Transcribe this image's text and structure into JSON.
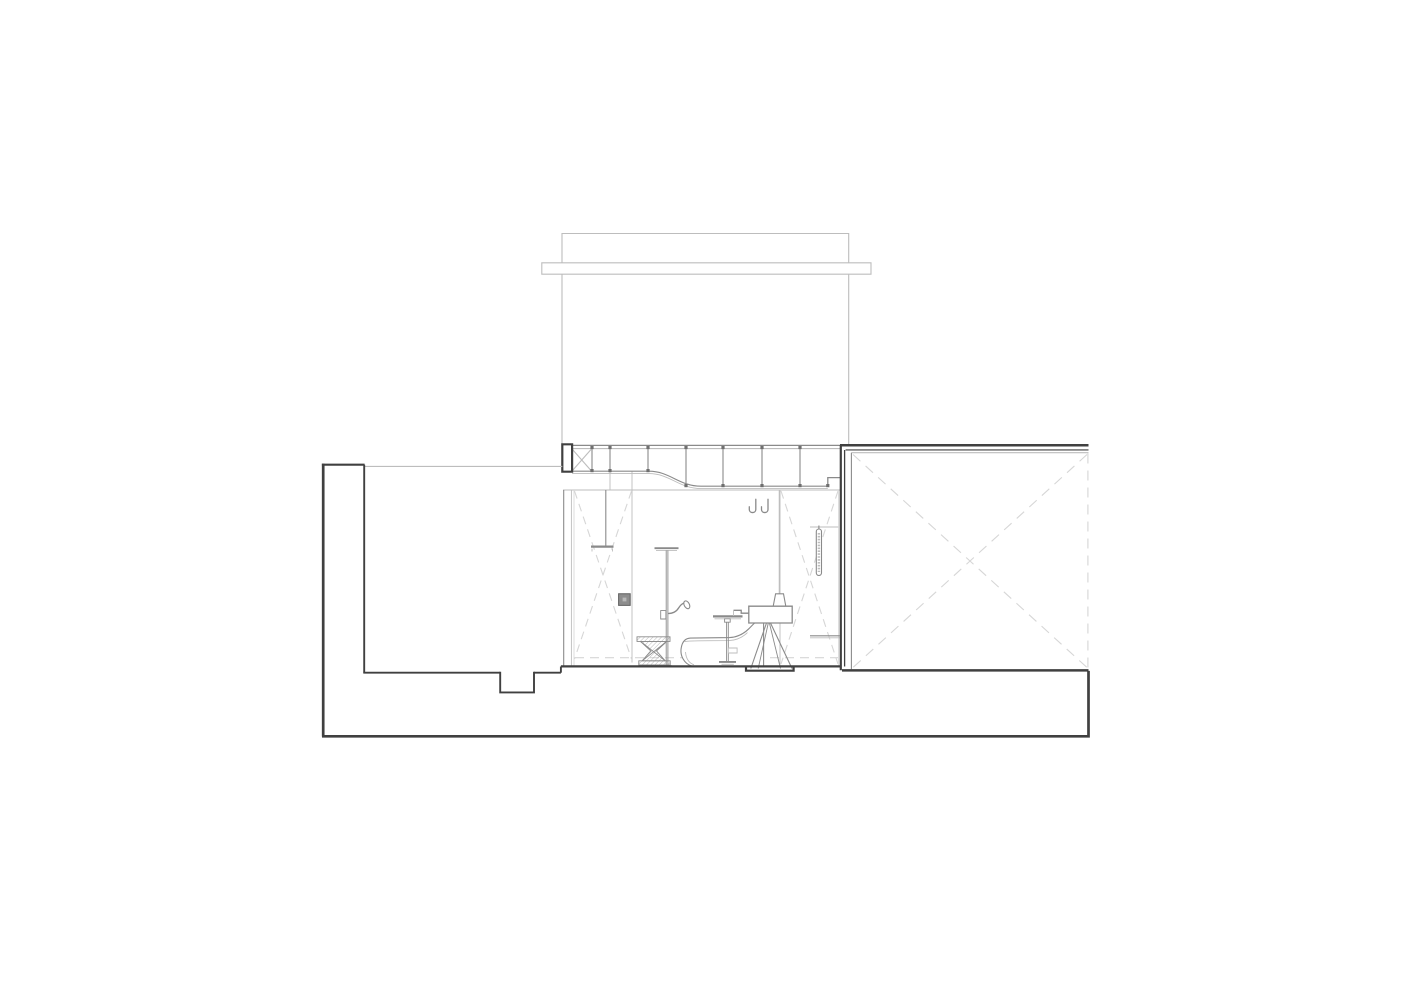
{
  "drawing": {
    "kind": "architectural-section-line-drawing",
    "palette": {
      "paper": "#ffffff",
      "line_dark": "#404040",
      "line_medium": "#8a8a8a",
      "line_light": "#bdbdbd",
      "line_faint": "#d6d6d6",
      "node_fill": "#6f6f6f",
      "panel_fill": "#8d8d8d",
      "panel_border": "#5f5f5f",
      "panel_inner": "#b8b8b8",
      "hatch_stroke": "#9a9a9a"
    },
    "elements": {
      "upper_volume": "tall upper volume outline",
      "roof_band": "horizontal band across upper volume",
      "roof_truss": "ceiling truss with posts, nodes and s-curved soffit",
      "truss_column": "section-cut column at truss left end",
      "left_wing": "left wing walls with underside notch",
      "right_box": "right volume with dashed cross bracing",
      "base_plinth": "continuous base plinth",
      "room": "central room shell with dashed wall braces",
      "ceiling_shower": "ceiling mounted shower head on drop rod",
      "shower_column": "freestanding shower column with hand spout",
      "control_panel": "wall control panel square",
      "stool": "hatched hourglass stool",
      "chaise": "low curved chaise longue",
      "side_table": "pedestal side table",
      "washstand": "washstand on a-frame trestle legs",
      "pendant_lamp": "pendant lamp over washstand",
      "robe_hooks": "pair of j-shaped robe hooks",
      "towel_rail": "vertical towel rail on right wall",
      "wall_shelf": "low shelf line at right wall",
      "floor_recess": "dark floor recess bar under washstand"
    }
  }
}
